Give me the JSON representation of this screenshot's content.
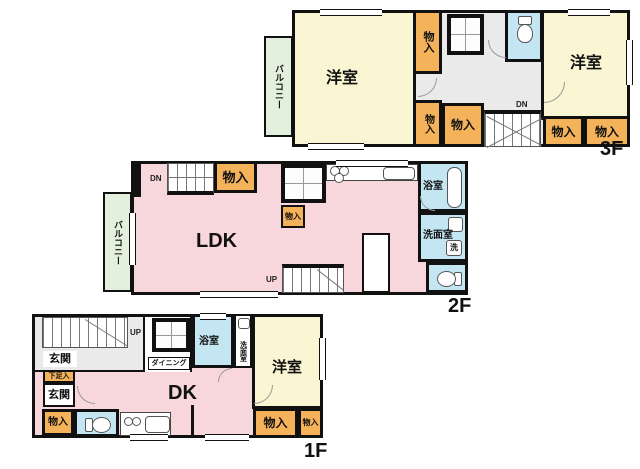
{
  "colors": {
    "bedroom_cream": "#faf5d2",
    "living_pink": "#f8d7dc",
    "storage_orange": "#f4b25a",
    "wet_area_blue": "#c4e6f2",
    "balcony_green": "#e3f0dd",
    "hall_gray": "#eaeaea",
    "wall_black": "#111111"
  },
  "floor3": {
    "floor_label": "3F",
    "balcony": "バルコニー",
    "bedroom_left": "洋室",
    "bedroom_right": "洋室",
    "closet_top": "物入",
    "closet_bottom_left": "物入",
    "closet_bottom_mid": "物入",
    "closet_right_1": "物入",
    "closet_right_2": "物入",
    "stairs_down": "DN"
  },
  "floor2": {
    "floor_label": "2F",
    "balcony": "バルコニー",
    "living": "LDK",
    "closet_top": "物入",
    "closet_small": "物入",
    "bath": "浴室",
    "washroom": "洗面室",
    "washer": "洗",
    "stairs_down": "DN",
    "stairs_up": "UP"
  },
  "floor1": {
    "floor_label": "1F",
    "entrance_upper": "玄関",
    "entrance_lower": "玄関",
    "shoe_closet": "下足入",
    "closet_left": "物入",
    "dining": "ダイニング",
    "dk": "DK",
    "bath": "浴室",
    "washroom": "洗面室",
    "bedroom": "洋室",
    "closet_right_large": "物入",
    "closet_right_small": "物入",
    "stairs_up": "UP"
  }
}
